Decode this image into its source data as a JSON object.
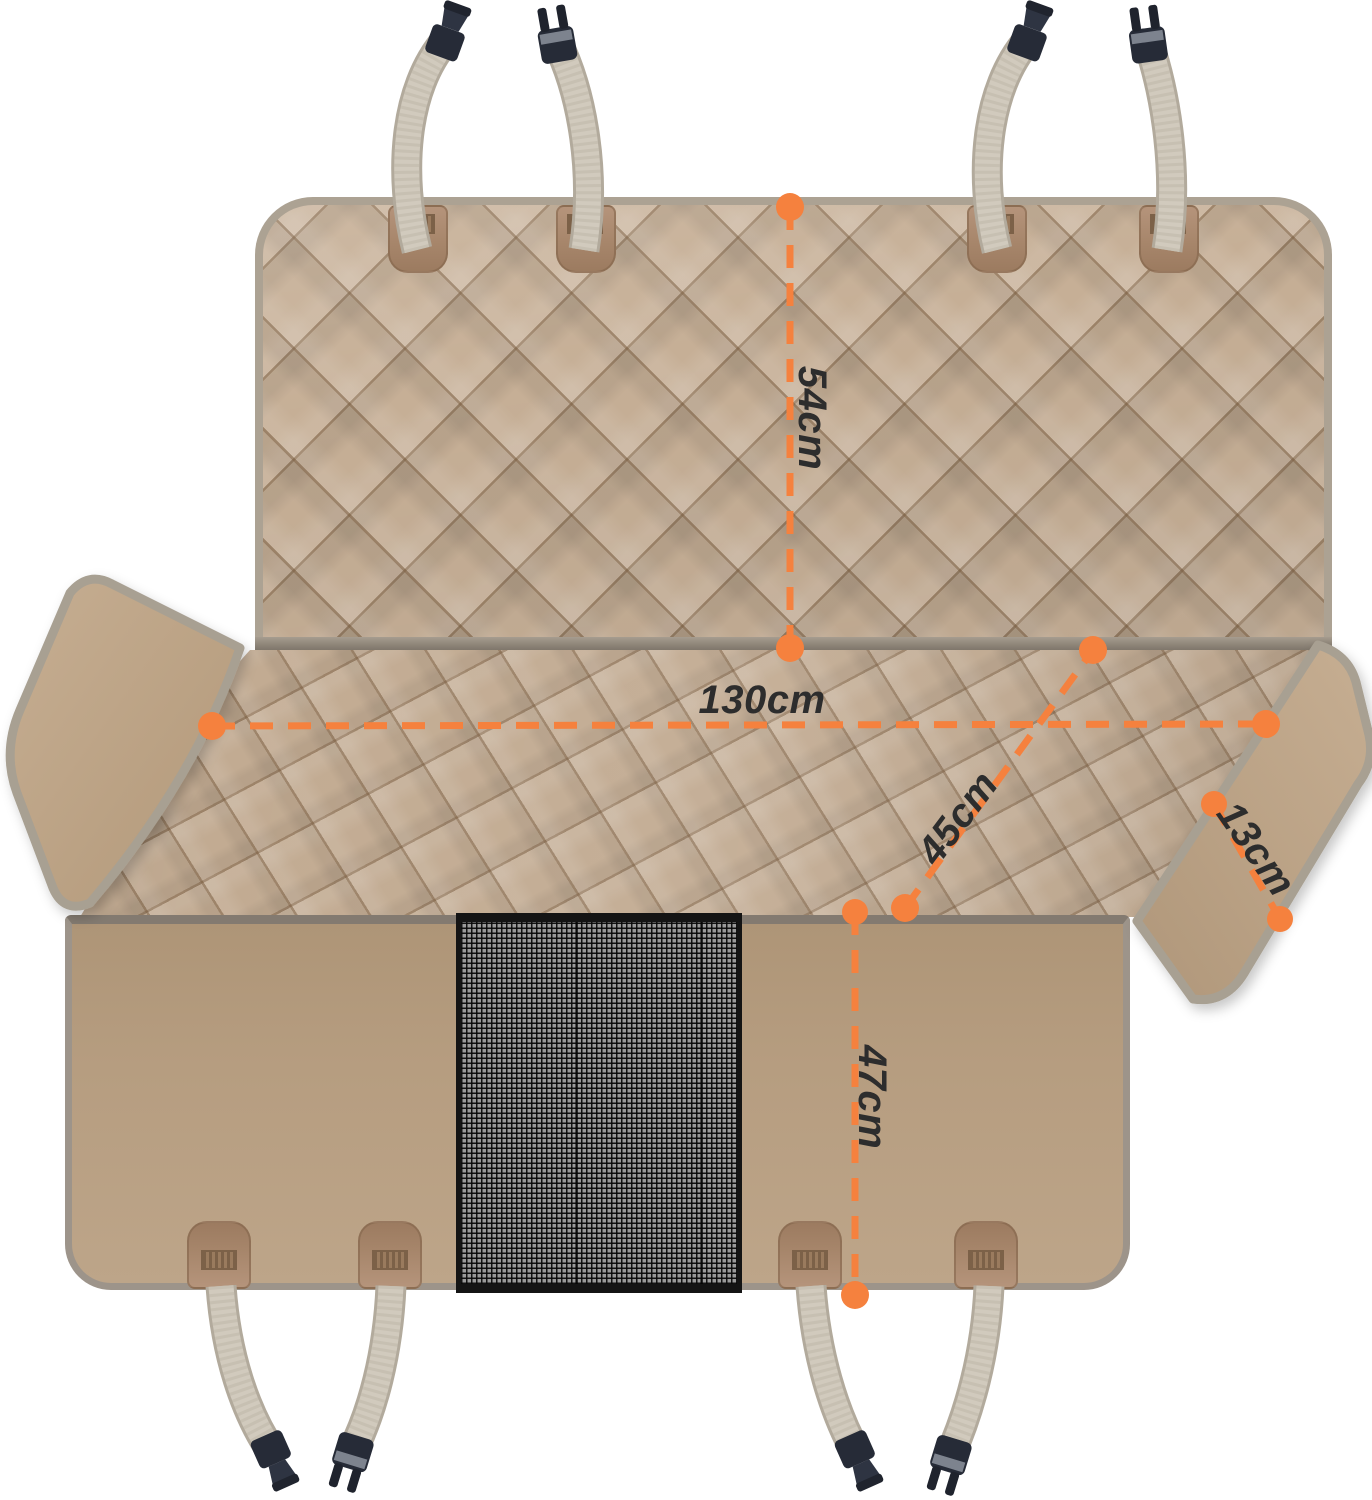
{
  "diagram": {
    "type": "product-dimension-diagram",
    "subject": "quilted car rear-seat pet cover with mesh window, side flaps, straps and buckles"
  },
  "measurements": {
    "backrest_height": {
      "label": "54cm"
    },
    "total_width": {
      "label": "130cm"
    },
    "seat_depth": {
      "label": "45cm"
    },
    "side_flap_width": {
      "label": "13cm"
    },
    "front_drop_height": {
      "label": "47cm"
    }
  },
  "style": {
    "accent_orange": "#F5813E",
    "label_color": "#2D2D2D",
    "fabric_quilted": "#C6AF96",
    "fabric_smooth_flap": "#C0A88B",
    "fabric_front_panel": "#B69D80",
    "patch_brown": "#A7866B",
    "strap_gray": "#D1CABD",
    "buckle_dark": "#262B37",
    "trim_gray": "#A8A092",
    "mesh_dark": "#141414",
    "background": "#FFFFFF"
  }
}
